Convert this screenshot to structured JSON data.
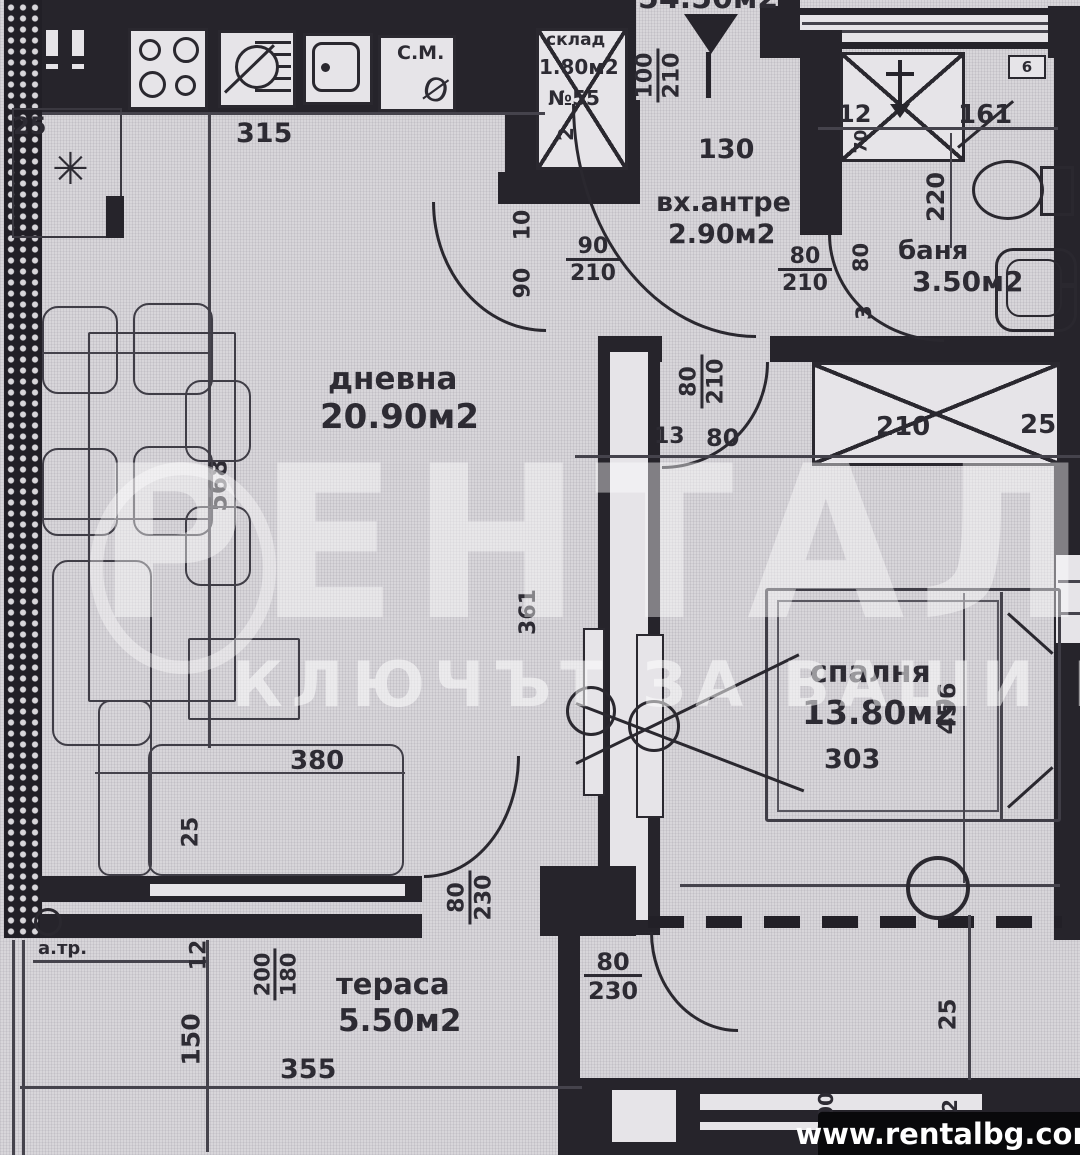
{
  "branding": {
    "watermark_title": "РЕНТАЛ",
    "watermark_tagline": "КЛЮЧЪТ ЗА ВАШИ МЕЧТИ",
    "website": "www.rentalbg.com"
  },
  "plan": {
    "total_area": "54.50м2"
  },
  "rooms": {
    "living": {
      "name": "дневна",
      "area": "20.90м2"
    },
    "hall": {
      "name": "вх.антре",
      "area": "2.90м2"
    },
    "bath": {
      "name": "баня",
      "area": "3.50м2"
    },
    "bedroom": {
      "name": "спалня",
      "area": "13.80м2",
      "dim_width": "303",
      "dim_height": "456"
    },
    "terrace": {
      "name": "тераса",
      "area": "5.50м2"
    },
    "storage": {
      "name": "склад",
      "area": "1.80м2",
      "code": "№55",
      "dim": "2"
    }
  },
  "fixtures": {
    "washing_machine": "С.М.",
    "drain": "а.тр.",
    "star": "✳",
    "diameter_mark": "Ø",
    "vent": "6"
  },
  "dims": {
    "top_left_25": "25",
    "kitchen_315": "315",
    "entr_100": "100",
    "entr_210": "210",
    "entr_130": "130",
    "hall_90": "90",
    "hall_210": "210",
    "side_10": "10",
    "side_90": "90",
    "bed_80": "80",
    "bed_210": "210",
    "off_13": "13",
    "off_80": "80",
    "bath_80": "80",
    "bath_210": "210",
    "shower_12": "12",
    "bath_161": "161",
    "shower_70": "70",
    "bath_220": "220",
    "bathside_80": "80",
    "bathside_3": "3",
    "ward_210": "210",
    "ward_25": "25",
    "liv_568": "568",
    "wall_361": "361",
    "sofa_380": "380",
    "sofa_25": "25",
    "livter_80": "80",
    "livter_230": "230",
    "bedter_80": "80",
    "bedter_230": "230",
    "ter_12": "12",
    "ter_200": "200",
    "ter_180": "180",
    "ter_150": "150",
    "ter_355": "355",
    "br_25": "25",
    "br_200": "200",
    "br_2": "2"
  }
}
